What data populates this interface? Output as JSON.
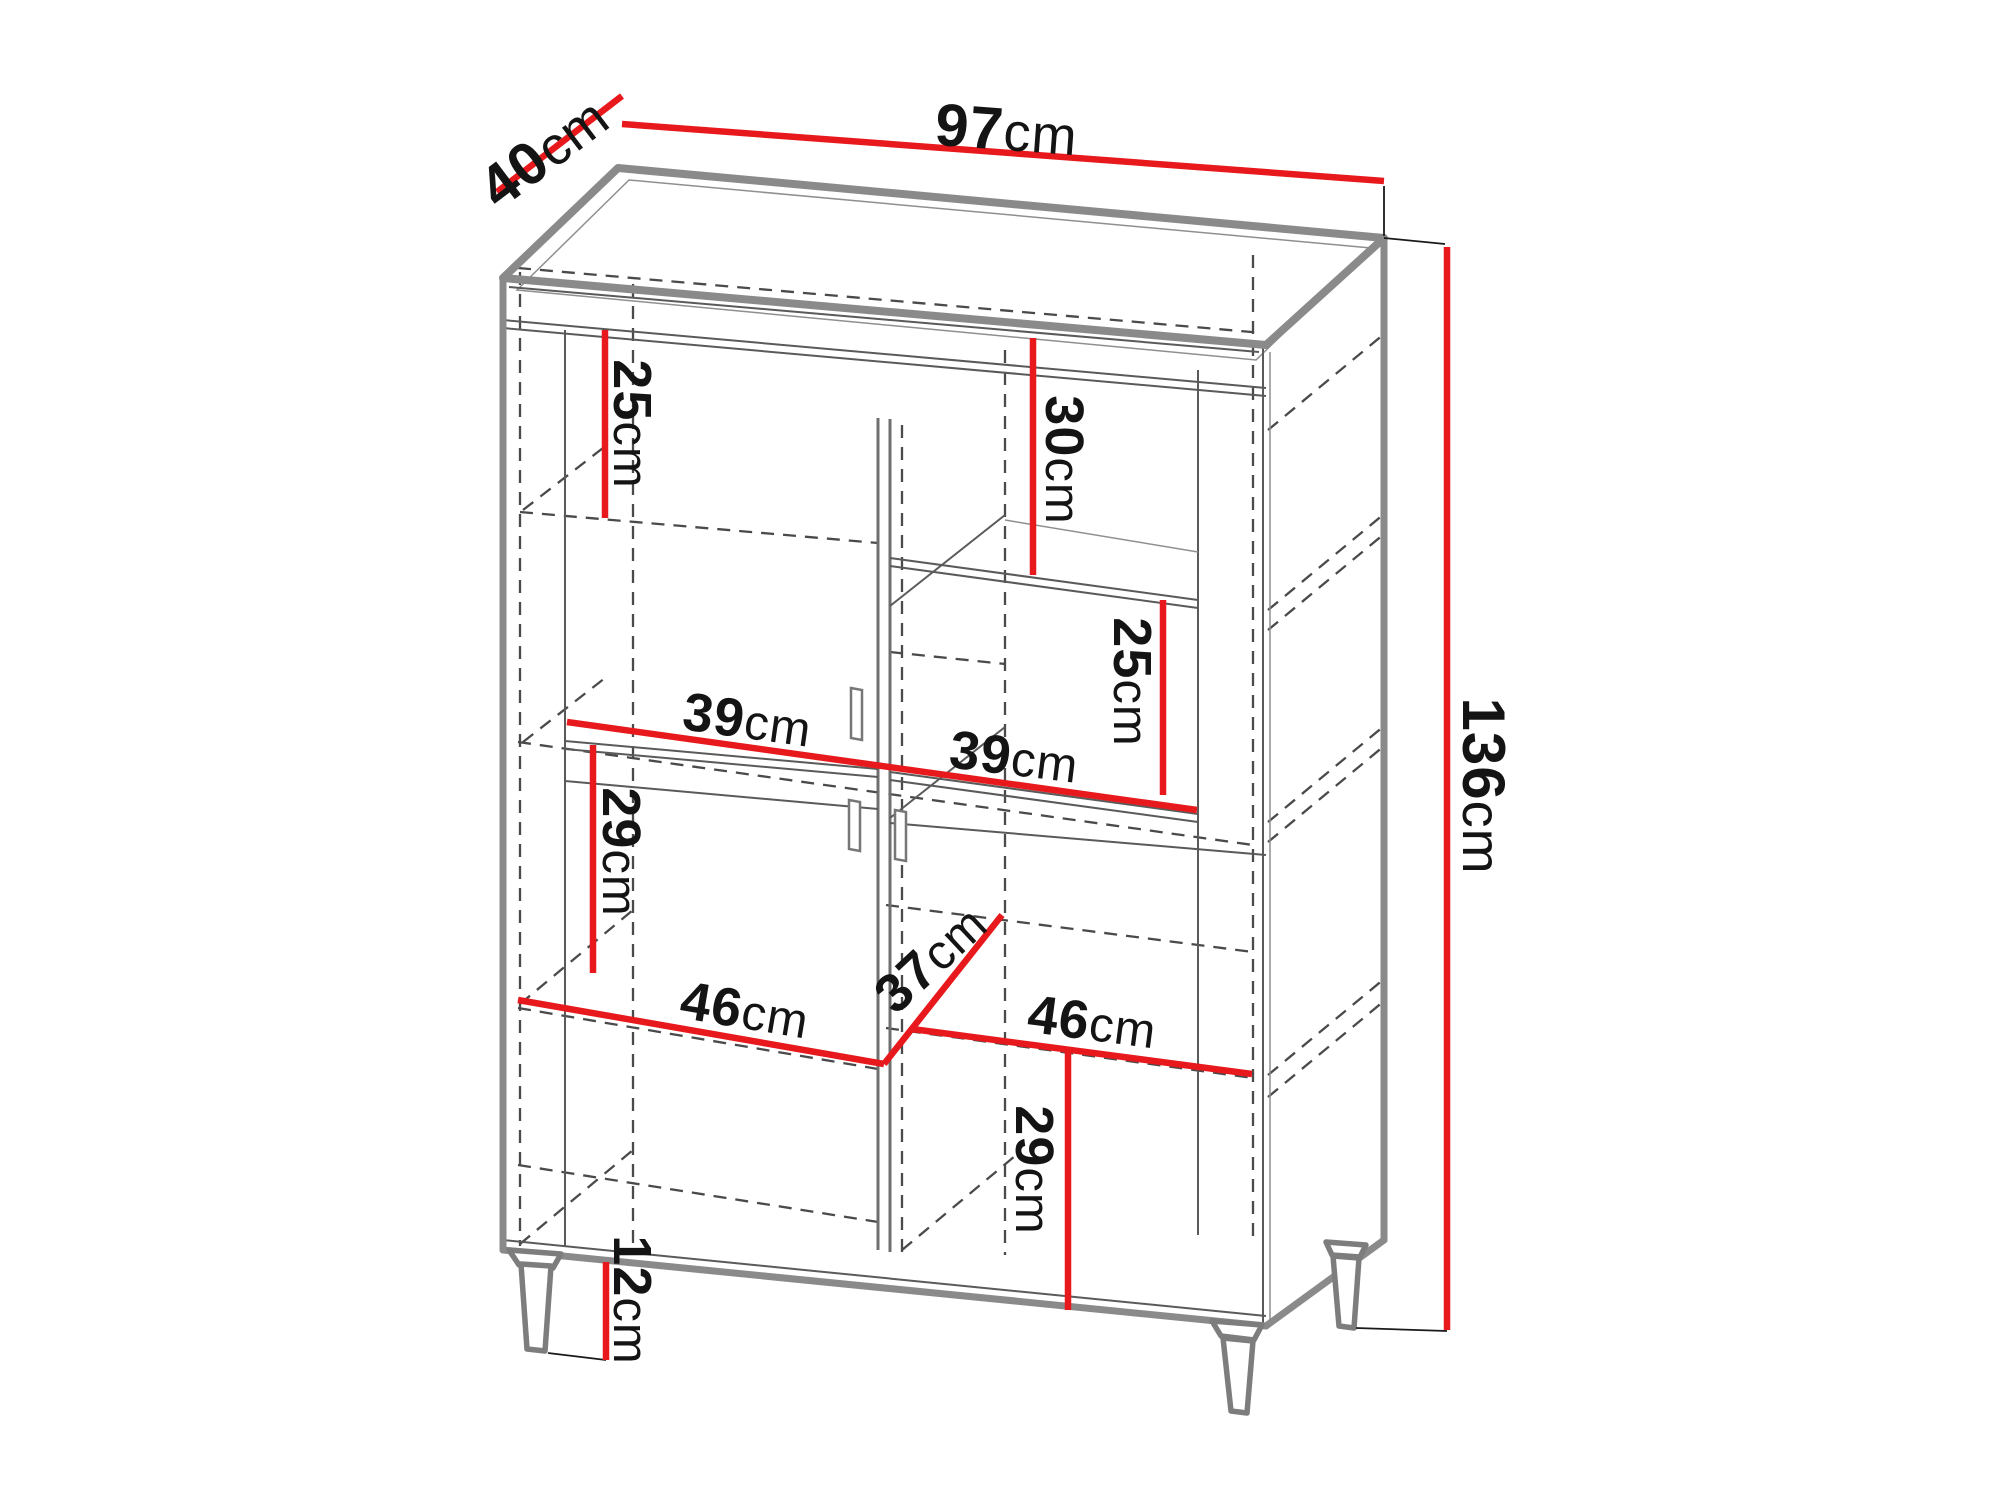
{
  "diagram": {
    "type": "furniture-dimension-diagram",
    "subject": "two-door display cabinet with shelves and legs",
    "unit": "cm",
    "accent_color": "#e8191c",
    "line_color": "#4a4a4a",
    "edge_color": "#8a8a8a",
    "dimensions": {
      "width": {
        "value": "97",
        "unit": "cm"
      },
      "depth": {
        "value": "40",
        "unit": "cm"
      },
      "height": {
        "value": "136",
        "unit": "cm"
      },
      "top_left_shelf": {
        "value": "25",
        "unit": "cm"
      },
      "top_right_shelf": {
        "value": "30",
        "unit": "cm"
      },
      "mid_right_shelf": {
        "value": "25",
        "unit": "cm"
      },
      "door_width_left": {
        "value": "39",
        "unit": "cm"
      },
      "door_width_right": {
        "value": "39",
        "unit": "cm"
      },
      "mid_left_shelf": {
        "value": "29",
        "unit": "cm"
      },
      "interior_width_left": {
        "value": "46",
        "unit": "cm"
      },
      "interior_depth": {
        "value": "37",
        "unit": "cm"
      },
      "interior_width_right": {
        "value": "46",
        "unit": "cm"
      },
      "bottom_right_shelf": {
        "value": "29",
        "unit": "cm"
      },
      "leg_height": {
        "value": "12",
        "unit": "cm"
      }
    }
  }
}
